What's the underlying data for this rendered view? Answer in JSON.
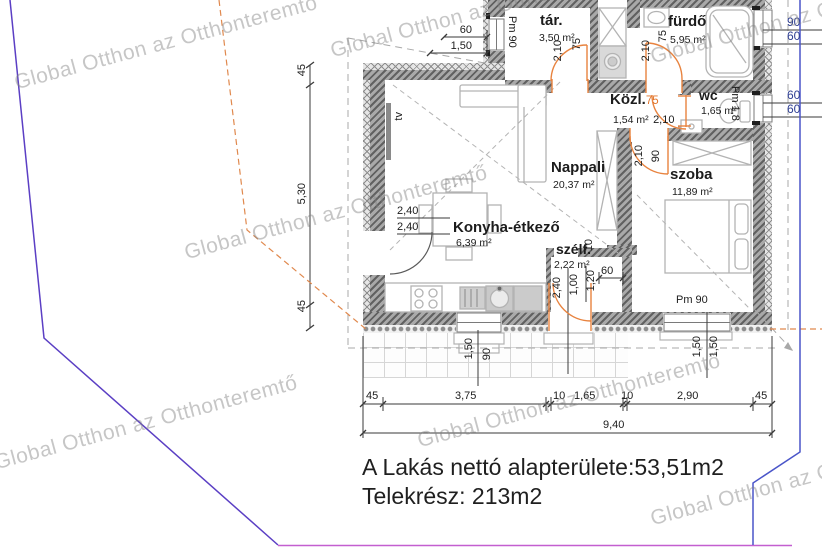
{
  "watermark": {
    "text": "Global Otthon az Otthonteremtő"
  },
  "summary": {
    "net_area": "A Lakás nettó alapterülete:53,51m2",
    "plot": "Telekrész: 213m2"
  },
  "rooms": {
    "tar": {
      "name": "tár.",
      "area": "3,50 m²"
    },
    "furdo": {
      "name": "fürdő",
      "area": "5,95 m²"
    },
    "kozl": {
      "name": "Közl.",
      "area": "1,54 m²",
      "door_w": "75",
      "door_h": "2,10"
    },
    "wc": {
      "name": "wc",
      "area": "1,65 m²",
      "parapet": "Pm 1,8"
    },
    "nappali": {
      "name": "Nappali",
      "area": "20,37 m²",
      "tv": "tv"
    },
    "szoba": {
      "name": "szoba",
      "area": "11,89 m²"
    },
    "konyha": {
      "name": "Konyha-étkező",
      "area": "6,39 m²",
      "dim1": "2,40",
      "dim2": "2,40"
    },
    "szelf": {
      "name": "szélf.",
      "area": "2,22 m²",
      "dim1": "2,40",
      "dim2": "1,00",
      "dim3": "1,20",
      "dim4": "60",
      "dim5": "10"
    }
  },
  "dims": {
    "left": {
      "a": "45",
      "b": "5,30",
      "c": "45"
    },
    "bottom": {
      "a": "45",
      "b": "3,75",
      "c": "10",
      "d": "1,65",
      "e": "10",
      "f": "2,90",
      "g": "45",
      "total": "9,40"
    },
    "top_window": {
      "w": "60",
      "len": "1,50",
      "parapet": "Pm 90"
    },
    "right_furdo": {
      "a": "90",
      "b": "60"
    },
    "right_wc": {
      "a": "60",
      "b": "60"
    },
    "door_tar": {
      "h": "2,10",
      "w": "75"
    },
    "door_furdo": {
      "h": "2,10",
      "w": "75"
    },
    "door_szoba": {
      "h": "2,10",
      "w": "90"
    },
    "window_kitchen": {
      "w": "1,50",
      "parapet": "90"
    },
    "window_szoba": {
      "parapet": "Pm 90",
      "a": "1,50",
      "b": "1,50"
    }
  }
}
